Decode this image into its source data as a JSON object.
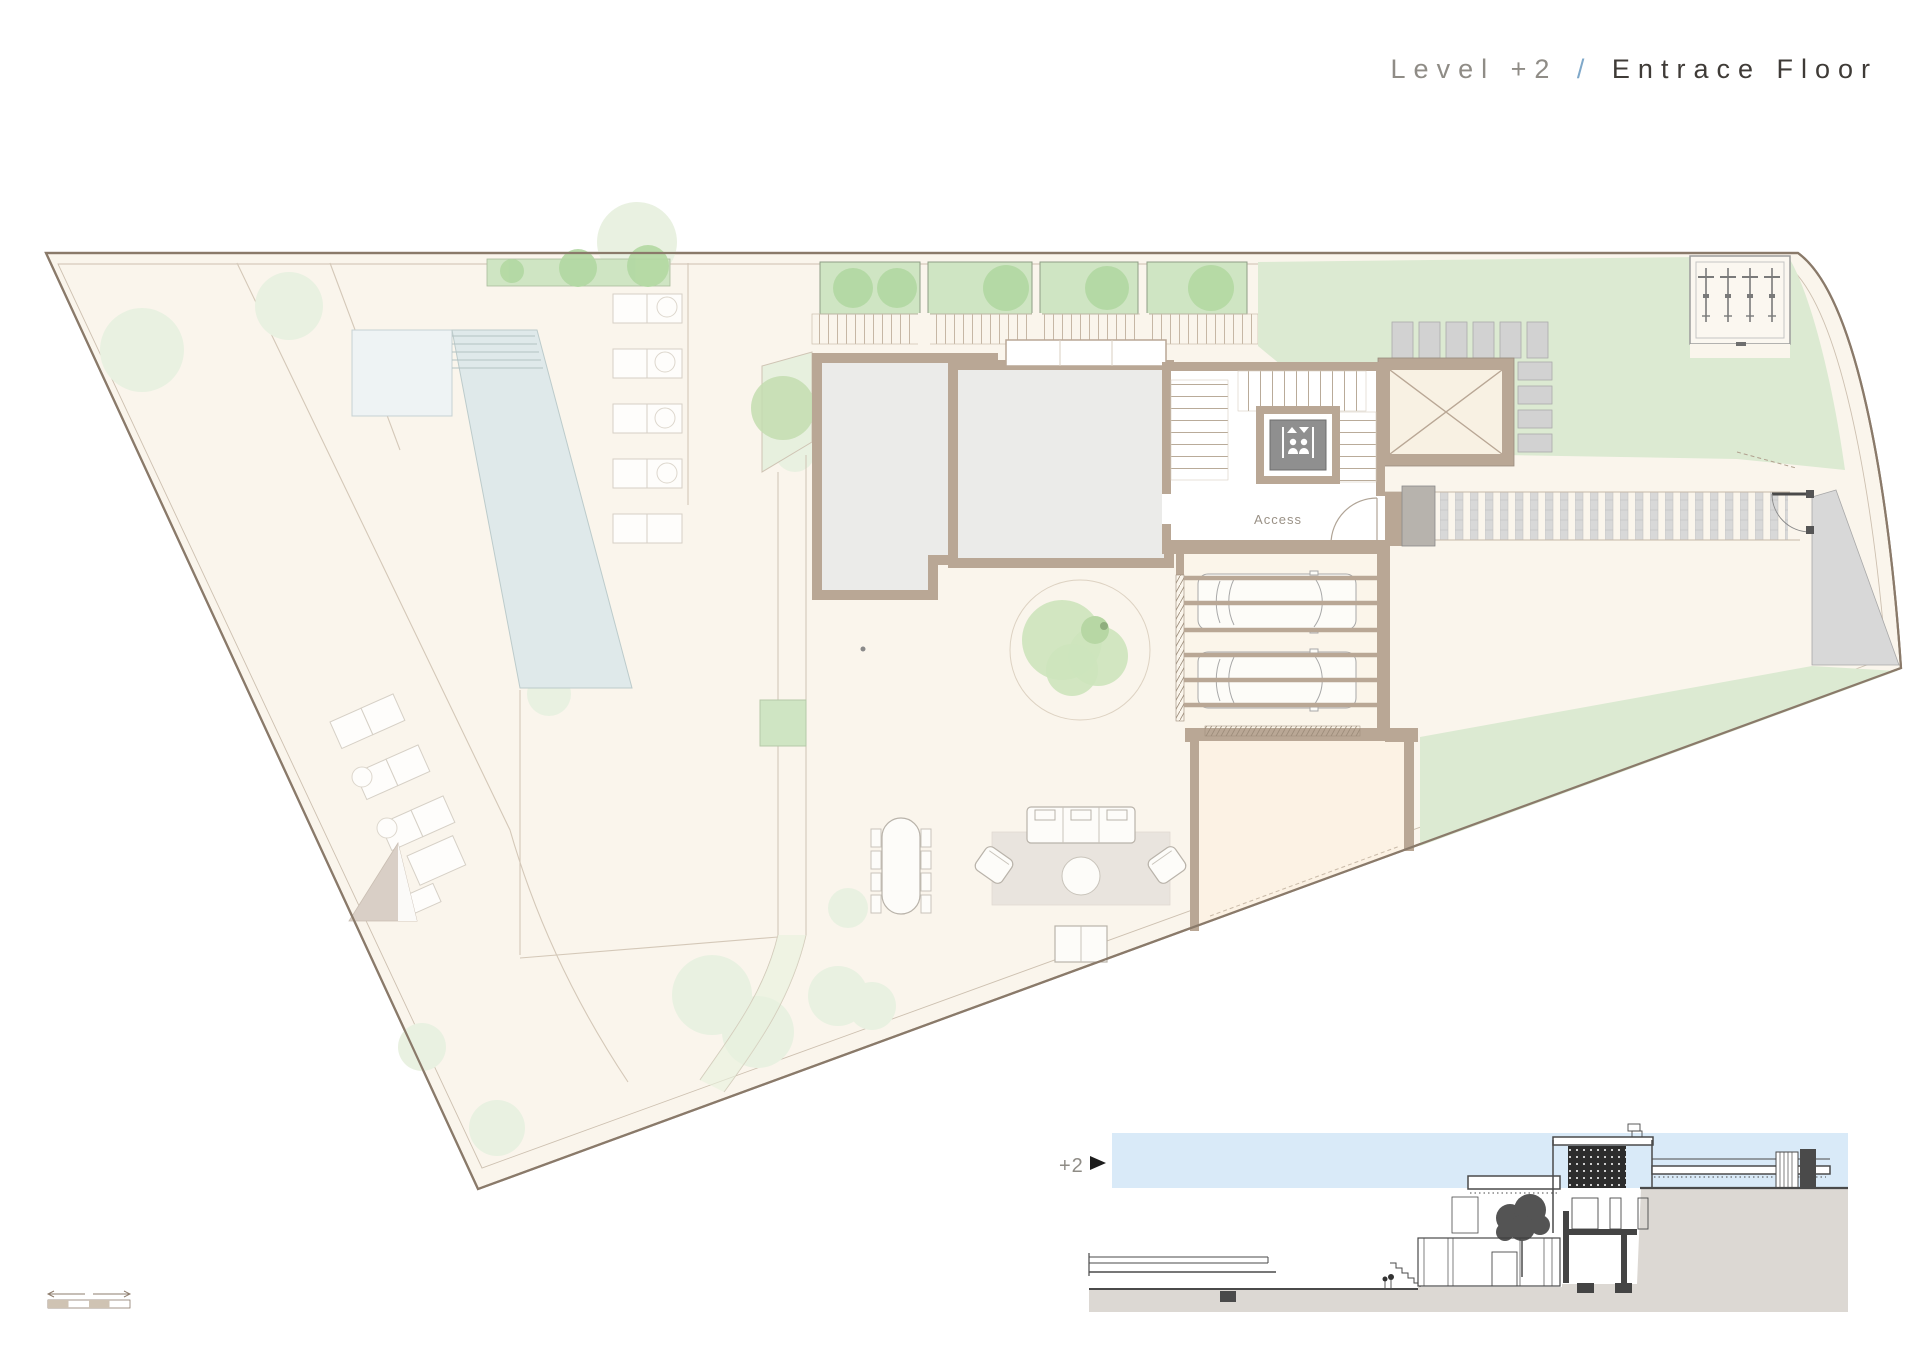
{
  "title": {
    "level": "Level +2",
    "separator": "/",
    "name": "Entrace Floor"
  },
  "plan": {
    "access_label": "Access",
    "icons": {
      "elevator": "elevator-icon",
      "bicycles": "bicycle-icon",
      "trees": "tree-icon",
      "shade": "shade-sail-icon",
      "cars": "car-icon"
    }
  },
  "section": {
    "marker_label": "+2"
  },
  "colors": {
    "site": "#faf5ec",
    "boundary": "#8a7a6a",
    "innerline": "#cdc0b0",
    "wall": "#b9a795",
    "room": "#ebebe9",
    "pool": "#dfe9ea",
    "poollight": "#eef3f4",
    "lawn": "#dcead2",
    "planter": "#cfe5c3",
    "bush": "#b2d8a2",
    "fainttree": "#e9f1e1",
    "peach": "#fcf2e4",
    "pave": "#d8d8d8",
    "grayitem": "#d2d2d2",
    "rug": "#e9e4de",
    "furnline": "#b9b3aa",
    "sky": "#d9eaf8",
    "ground": "#dcd8d3",
    "dark": "#3f3f3f",
    "titlegray": "#8f8c86",
    "titleblue": "#7fa8c9",
    "titledark": "#3f3b37",
    "labelgray": "#9a9186"
  }
}
